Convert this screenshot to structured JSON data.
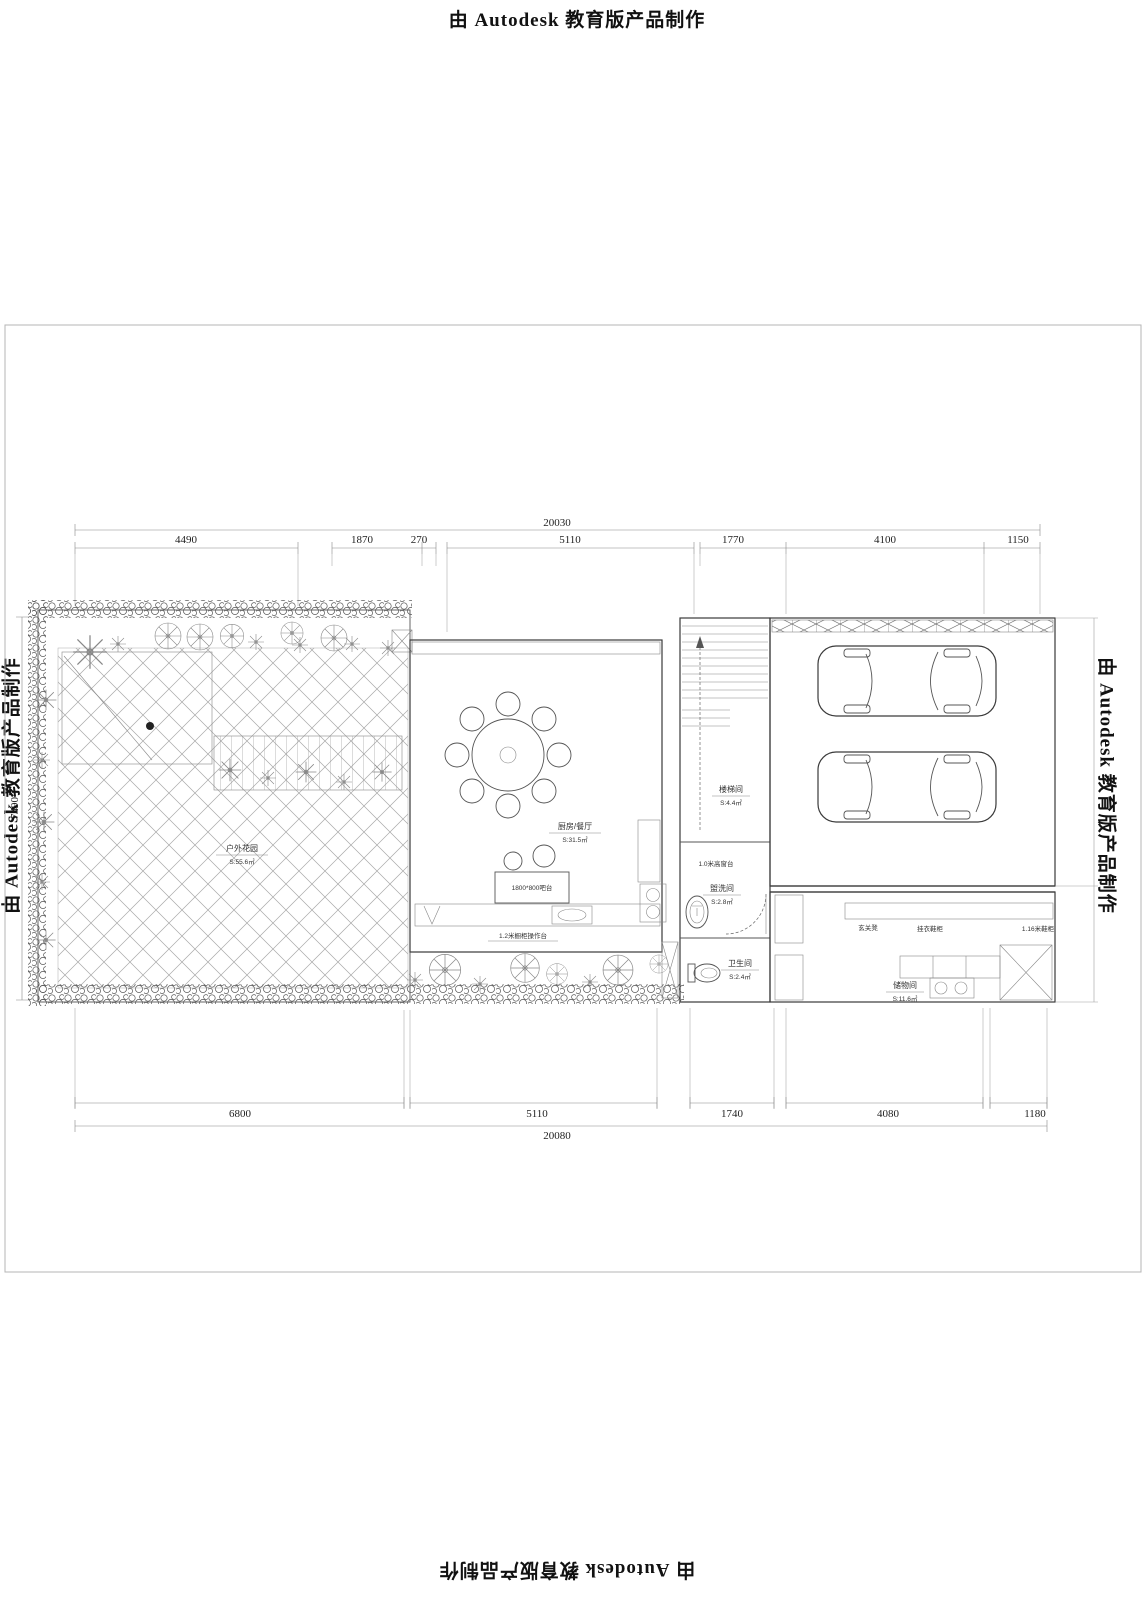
{
  "stamps": {
    "top": "由 Autodesk 教育版产品制作",
    "bottom": "由 Autodesk 教育版产品制作",
    "left": "由 Autodesk 教育版产品制作",
    "right": "由 Autodesk 教育版产品制作"
  },
  "dimensions": {
    "top": {
      "total": "20030",
      "seg": [
        "4490",
        "1870",
        "270",
        "5110",
        "1770",
        "4100",
        "1150"
      ]
    },
    "bottom": {
      "total": "20080",
      "seg": [
        "6800",
        "5110",
        "1740",
        "4080",
        "1180"
      ]
    },
    "left": {
      "height": "7490"
    }
  },
  "rooms": {
    "garden": {
      "name": "户外花园",
      "area": "S:55.6㎡"
    },
    "kitchen": {
      "name": "厨房/餐厅",
      "area": "S:31.5㎡"
    },
    "stair": {
      "name": "楼梯间",
      "area": "S:4.4㎡"
    },
    "wash": {
      "name": "盥洗间",
      "area": "S:2.8㎡"
    },
    "toilet": {
      "name": "卫生间",
      "area": "S:2.4㎡"
    },
    "storage": {
      "name": "储物间",
      "area": "S:11.6㎡"
    }
  },
  "annotations": {
    "bar_table": "1800*800吧台",
    "counter": "1.2米橱柜操作台",
    "window_sill": "1.0米高窗台",
    "entry_bench": "玄关凳",
    "shoe_cabinet": "挂衣鞋柜",
    "shoe_cabinet2": "1.16米鞋柜"
  }
}
